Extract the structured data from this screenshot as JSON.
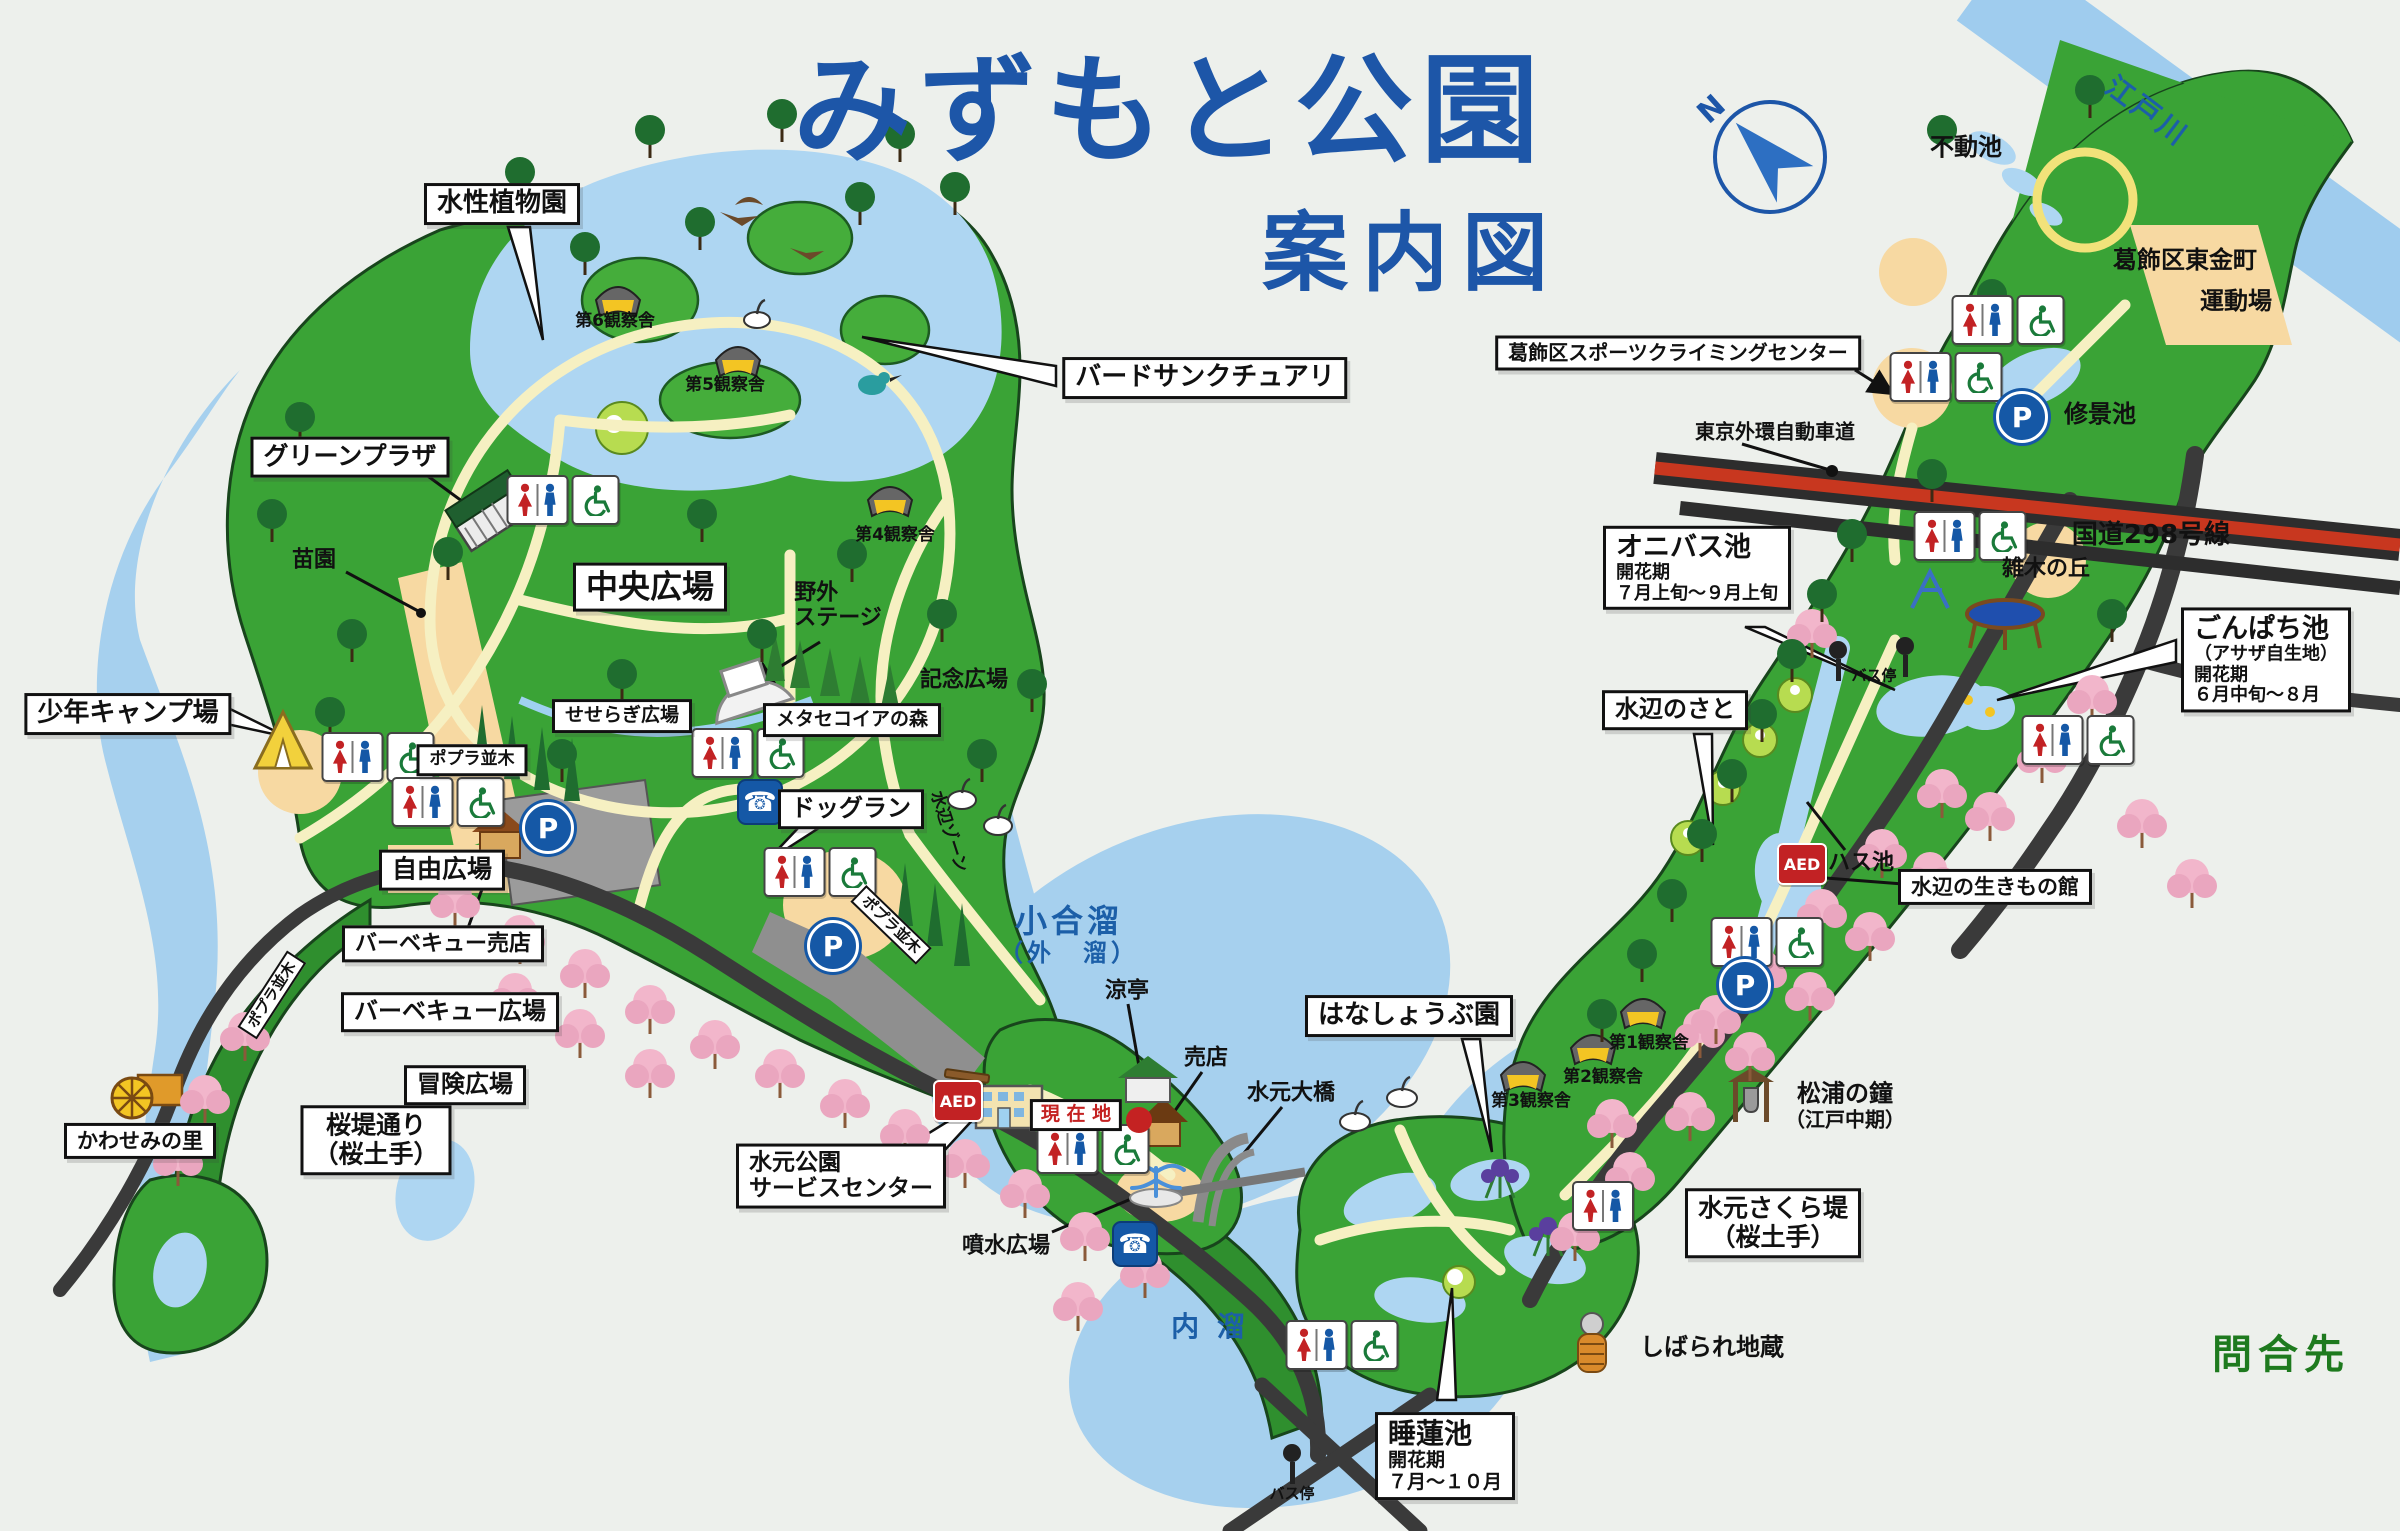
{
  "title": {
    "main": "みずもと公園",
    "sub": "案内図"
  },
  "compass": {
    "north_label": "N"
  },
  "colors": {
    "title_blue": "#1d56a8",
    "water": "#a6d0ee",
    "park_green": "#3aa336",
    "path_cream": "#f6f0c2",
    "road_dark": "#3a3a3a",
    "highway_red": "#c8371f",
    "cherry_pink": "#f2b6cb",
    "inquiry_green": "#1e7a1e",
    "aed_red": "#c22224",
    "facility_blue": "#1558a6",
    "current_location_red": "#c42222"
  },
  "labels": [
    {
      "name": "aquatic-plant-garden",
      "kind": "box",
      "x": 502,
      "y": 204,
      "lines": [
        [
          "水性植物園",
          26
        ]
      ]
    },
    {
      "name": "bird-sanctuary",
      "kind": "box",
      "x": 1205,
      "y": 378,
      "lines": [
        [
          "バードサンクチュアリ",
          26
        ]
      ]
    },
    {
      "name": "green-plaza",
      "kind": "box",
      "x": 350,
      "y": 457,
      "lines": [
        [
          "グリーンプラザ",
          25
        ]
      ]
    },
    {
      "name": "youth-camp-ground",
      "kind": "box",
      "x": 128,
      "y": 714,
      "lines": [
        [
          "少年キャンプ場",
          26
        ]
      ]
    },
    {
      "name": "central-plaza",
      "kind": "box",
      "x": 650,
      "y": 587,
      "lines": [
        [
          "中央広場",
          32
        ]
      ]
    },
    {
      "name": "seseragi-plaza",
      "kind": "box",
      "x": 622,
      "y": 716,
      "lines": [
        [
          "せせらぎ広場",
          19
        ]
      ]
    },
    {
      "name": "poplar-row-sign-1",
      "kind": "box",
      "x": 472,
      "y": 760,
      "lines": [
        [
          "ポプラ並木",
          17
        ]
      ]
    },
    {
      "name": "free-plaza",
      "kind": "box",
      "x": 442,
      "y": 870,
      "lines": [
        [
          "自由広場",
          25
        ]
      ]
    },
    {
      "name": "bbq-shop",
      "kind": "box",
      "x": 443,
      "y": 944,
      "lines": [
        [
          "バーベキュー売店",
          22
        ]
      ]
    },
    {
      "name": "bbq-plaza",
      "kind": "box",
      "x": 450,
      "y": 1012,
      "lines": [
        [
          "バーベキュー広場",
          24
        ]
      ]
    },
    {
      "name": "adventure-plaza",
      "kind": "box",
      "x": 465,
      "y": 1085,
      "lines": [
        [
          "冒険広場",
          24
        ]
      ]
    },
    {
      "name": "kawasemi-village",
      "kind": "box",
      "x": 140,
      "y": 1141,
      "lines": [
        [
          "かわせみの里",
          21
        ]
      ]
    },
    {
      "name": "sakura-bank-street",
      "kind": "box",
      "x": 376,
      "y": 1140,
      "lines": [
        [
          "桜堤通り",
          25
        ],
        [
          "（桜土手）",
          25
        ]
      ]
    },
    {
      "name": "dog-run",
      "kind": "box",
      "x": 851,
      "y": 809,
      "lines": [
        [
          "ドッグラン",
          24
        ]
      ]
    },
    {
      "name": "metasequoia-forest",
      "kind": "box",
      "x": 852,
      "y": 720,
      "lines": [
        [
          "メタセコイアの森",
          19
        ]
      ]
    },
    {
      "name": "park-service-center",
      "kind": "box",
      "align": "l",
      "x": 841,
      "y": 1176,
      "lines": [
        [
          "水元公園",
          23
        ],
        [
          "サービスセンター",
          23
        ]
      ]
    },
    {
      "name": "current-location",
      "kind": "red",
      "x": 1076,
      "y": 1115,
      "lines": [
        [
          "現 在 地",
          19
        ]
      ]
    },
    {
      "name": "iris-garden",
      "kind": "box",
      "x": 1409,
      "y": 1016,
      "lines": [
        [
          "はなしょうぶ園",
          26
        ]
      ]
    },
    {
      "name": "water-lily-pond",
      "kind": "box",
      "align": "l",
      "x": 1445,
      "y": 1456,
      "lines": [
        [
          "睡蓮池",
          28
        ],
        [
          "開花期",
          19
        ],
        [
          "７月～１０月",
          19
        ]
      ]
    },
    {
      "name": "mizumoto-sakura-bank",
      "kind": "box",
      "x": 1773,
      "y": 1223,
      "lines": [
        [
          "水元さくら堤",
          25
        ],
        [
          "（桜土手）",
          25
        ]
      ]
    },
    {
      "name": "onibasu-pond",
      "kind": "box",
      "align": "l",
      "x": 1697,
      "y": 568,
      "lines": [
        [
          "オニバス池",
          27
        ],
        [
          "開花期",
          18
        ],
        [
          "７月上旬～９月上旬",
          18
        ]
      ]
    },
    {
      "name": "mizube-no-sato",
      "kind": "box",
      "x": 1675,
      "y": 710,
      "lines": [
        [
          "水辺のさと",
          24
        ]
      ]
    },
    {
      "name": "gonpachi-pond",
      "kind": "box",
      "align": "l",
      "x": 2266,
      "y": 660,
      "lines": [
        [
          "ごんぱち池",
          27
        ],
        [
          "（アサザ自生地）",
          18
        ],
        [
          "開花期",
          18
        ],
        [
          "６月中旬～８月",
          18
        ]
      ]
    },
    {
      "name": "sports-climbing-center",
      "kind": "box",
      "x": 1678,
      "y": 353,
      "lines": [
        [
          "葛飾区スポーツクライミングセンター",
          20
        ]
      ]
    },
    {
      "name": "waterside-creatures-house",
      "kind": "box",
      "x": 1995,
      "y": 887,
      "lines": [
        [
          "水辺の生きもの館",
          21
        ]
      ]
    },
    {
      "name": "observation-hut-6",
      "kind": "plain",
      "x": 615,
      "y": 322,
      "lines": [
        [
          "第6観察舎",
          17
        ]
      ]
    },
    {
      "name": "observation-hut-5",
      "kind": "plain",
      "x": 725,
      "y": 386,
      "lines": [
        [
          "第5観察舎",
          17
        ]
      ]
    },
    {
      "name": "observation-hut-4",
      "kind": "plain",
      "x": 895,
      "y": 536,
      "lines": [
        [
          "第4観察舎",
          17
        ]
      ]
    },
    {
      "name": "observation-hut-3",
      "kind": "plain",
      "x": 1531,
      "y": 1102,
      "lines": [
        [
          "第3観察舎",
          17
        ]
      ]
    },
    {
      "name": "observation-hut-2",
      "kind": "plain",
      "x": 1603,
      "y": 1078,
      "lines": [
        [
          "第2観察舎",
          17
        ]
      ]
    },
    {
      "name": "observation-hut-1",
      "kind": "plain",
      "x": 1649,
      "y": 1044,
      "lines": [
        [
          "第1観察舎",
          17
        ]
      ]
    },
    {
      "name": "nursery-garden",
      "kind": "plain",
      "x": 314,
      "y": 560,
      "lines": [
        [
          "苗園",
          22
        ]
      ]
    },
    {
      "name": "outdoor-stage",
      "kind": "plain",
      "align": "l",
      "x": 838,
      "y": 606,
      "lines": [
        [
          "野外",
          22
        ],
        [
          "ステージ",
          22
        ]
      ]
    },
    {
      "name": "memorial-plaza",
      "kind": "plain",
      "x": 964,
      "y": 680,
      "lines": [
        [
          "記念広場",
          22
        ]
      ]
    },
    {
      "name": "ryotei-pavilion",
      "kind": "plain",
      "x": 1127,
      "y": 991,
      "lines": [
        [
          "涼亭",
          22
        ]
      ]
    },
    {
      "name": "kiosk",
      "kind": "plain",
      "x": 1206,
      "y": 1058,
      "lines": [
        [
          "売店",
          22
        ]
      ]
    },
    {
      "name": "mizumoto-bridge",
      "kind": "plain",
      "x": 1291,
      "y": 1093,
      "lines": [
        [
          "水元大橋",
          22
        ]
      ]
    },
    {
      "name": "fountain-plaza",
      "kind": "plain",
      "x": 1006,
      "y": 1246,
      "lines": [
        [
          "噴水広場",
          22
        ]
      ]
    },
    {
      "name": "shibarare-jizo",
      "kind": "plain",
      "x": 1712,
      "y": 1348,
      "lines": [
        [
          "しばられ地蔵",
          24
        ]
      ]
    },
    {
      "name": "matsuura-bell",
      "kind": "plain",
      "x": 1845,
      "y": 1106,
      "lines": [
        [
          "松浦の鐘",
          24
        ],
        [
          "（江戸中期）",
          20
        ]
      ]
    },
    {
      "name": "fudo-pond",
      "kind": "plain",
      "x": 1966,
      "y": 148,
      "lines": [
        [
          "不動池",
          24
        ]
      ]
    },
    {
      "name": "higashikanamachi-ground-line1",
      "kind": "plain",
      "x": 2185,
      "y": 261,
      "lines": [
        [
          "葛飾区東金町",
          24
        ]
      ]
    },
    {
      "name": "higashikanamachi-ground-line2",
      "kind": "plain",
      "x": 2236,
      "y": 302,
      "lines": [
        [
          "運動場",
          24
        ]
      ]
    },
    {
      "name": "shukei-pond",
      "kind": "plain",
      "x": 2100,
      "y": 415,
      "lines": [
        [
          "修景池",
          24
        ]
      ]
    },
    {
      "name": "tokyo-gaikan-expressway",
      "kind": "plain",
      "x": 1775,
      "y": 432,
      "lines": [
        [
          "東京外環自動車道",
          20
        ]
      ]
    },
    {
      "name": "route-298",
      "kind": "plain",
      "x": 2151,
      "y": 536,
      "lines": [
        [
          "国道298号線",
          26
        ]
      ]
    },
    {
      "name": "zoki-hill",
      "kind": "plain",
      "x": 2046,
      "y": 569,
      "lines": [
        [
          "雑木の丘",
          22
        ]
      ]
    },
    {
      "name": "lotus-pond",
      "kind": "plain",
      "x": 1861,
      "y": 863,
      "lines": [
        [
          "ハス池",
          22
        ]
      ]
    },
    {
      "name": "bus-stop-north",
      "kind": "plain",
      "x": 1874,
      "y": 676,
      "lines": [
        [
          "バス停",
          15
        ]
      ]
    },
    {
      "name": "bus-stop-south",
      "kind": "plain",
      "x": 1292,
      "y": 1494,
      "lines": [
        [
          "バス停",
          15
        ]
      ]
    },
    {
      "name": "inquiry",
      "kind": "green",
      "x": 2281,
      "y": 1355,
      "lines": [
        [
          "問合先",
          40
        ]
      ]
    },
    {
      "name": "koaidame-lake",
      "kind": "water",
      "x": 1069,
      "y": 935,
      "lines": [
        [
          "小合溜",
          32
        ],
        [
          "（外　溜）",
          24
        ]
      ]
    },
    {
      "name": "uchidame-lake",
      "kind": "water",
      "x": 1210,
      "y": 1327,
      "lines": [
        [
          "内 溜",
          28
        ]
      ]
    },
    {
      "name": "edogawa-river",
      "kind": "water",
      "x": 2147,
      "y": 112,
      "rot": 37,
      "lines": [
        [
          "江戸川",
          28
        ]
      ]
    },
    {
      "name": "mizube-zone",
      "kind": "plain",
      "x": 948,
      "y": 832,
      "rot": 72,
      "lines": [
        [
          "水辺ゾーン",
          17
        ]
      ]
    },
    {
      "name": "poplar-row-sign-2",
      "kind": "ribbon",
      "x": 272,
      "y": 995,
      "rot": -57,
      "lines": [
        [
          "ポプラ並木",
          15
        ]
      ]
    },
    {
      "name": "poplar-row-sign-3",
      "kind": "ribbon",
      "x": 891,
      "y": 925,
      "rot": 44,
      "lines": [
        [
          "ポプラ並木",
          15
        ]
      ]
    }
  ],
  "icons": [
    {
      "name": "restroom-icon",
      "type": "toilet-wc",
      "x": 563,
      "y": 500
    },
    {
      "name": "restroom-icon",
      "type": "toilet-wc",
      "x": 378,
      "y": 757
    },
    {
      "name": "restroom-icon",
      "type": "toilet-wc",
      "x": 448,
      "y": 802
    },
    {
      "name": "restroom-icon",
      "type": "toilet-wc",
      "x": 748,
      "y": 753
    },
    {
      "name": "restroom-icon",
      "type": "toilet-wc",
      "x": 820,
      "y": 872
    },
    {
      "name": "restroom-icon",
      "type": "toilet-wc",
      "x": 1093,
      "y": 1149
    },
    {
      "name": "restroom-icon",
      "type": "toilet-wc",
      "x": 1342,
      "y": 1345
    },
    {
      "name": "restroom-icon",
      "type": "toilet-wc",
      "x": 1767,
      "y": 942
    },
    {
      "name": "restroom-icon",
      "type": "toilet-wc",
      "x": 1946,
      "y": 377
    },
    {
      "name": "restroom-icon",
      "type": "toilet-wc",
      "x": 2008,
      "y": 320
    },
    {
      "name": "restroom-icon",
      "type": "toilet-wc",
      "x": 1970,
      "y": 536
    },
    {
      "name": "restroom-icon",
      "type": "toilet-wc",
      "x": 2078,
      "y": 740
    },
    {
      "name": "restroom-icon",
      "type": "toilet",
      "x": 1603,
      "y": 1206
    },
    {
      "name": "parking-icon",
      "type": "parking",
      "label": "P",
      "x": 548,
      "y": 828
    },
    {
      "name": "parking-icon",
      "type": "parking",
      "label": "P",
      "x": 833,
      "y": 946
    },
    {
      "name": "parking-icon",
      "type": "parking",
      "label": "P",
      "x": 1745,
      "y": 985
    },
    {
      "name": "parking-icon",
      "type": "parking",
      "label": "P",
      "x": 2022,
      "y": 417
    },
    {
      "name": "public-phone-icon",
      "type": "phone",
      "x": 760,
      "y": 802
    },
    {
      "name": "public-phone-icon",
      "type": "phone",
      "x": 1135,
      "y": 1244
    },
    {
      "name": "aed-icon",
      "type": "aed",
      "label": "AED",
      "x": 958,
      "y": 1101
    },
    {
      "name": "aed-icon",
      "type": "aed",
      "label": "AED",
      "x": 1802,
      "y": 864
    },
    {
      "name": "bus-stop-icon",
      "type": "bus",
      "x": 1838,
      "y": 661
    },
    {
      "name": "bus-stop-icon",
      "type": "bus",
      "x": 1905,
      "y": 657
    },
    {
      "name": "bus-stop-icon",
      "type": "bus",
      "x": 1292,
      "y": 1464
    },
    {
      "name": "current-location-dot",
      "type": "dot",
      "x": 1139,
      "y": 1120
    }
  ]
}
